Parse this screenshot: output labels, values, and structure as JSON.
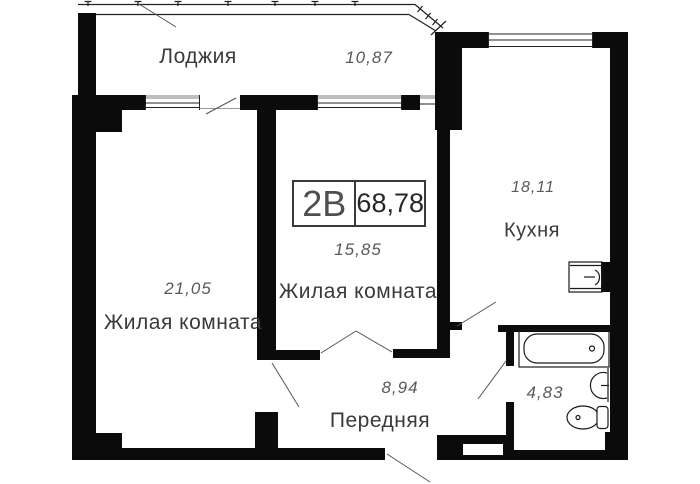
{
  "unit": {
    "type_label": "2В",
    "total_area": "68,78"
  },
  "rooms": {
    "loggia": {
      "name": "Лоджия",
      "area": "10,87"
    },
    "living_left": {
      "name": "Жилая комната",
      "area": "21,05"
    },
    "living_middle": {
      "name": "Жилая комната",
      "area": "15,85"
    },
    "kitchen": {
      "name": "Кухня",
      "area": "18,11"
    },
    "hallway": {
      "name": "Передняя",
      "area": "8,94"
    },
    "bathroom": {
      "area": "4,83"
    }
  },
  "colors": {
    "wall": "#0b0b0b",
    "thin_line": "#222222",
    "leader_line": "#555555",
    "window_band": "#bdbdbd",
    "label_text": "#3a3a3a",
    "area_text": "#5a5a5a"
  }
}
